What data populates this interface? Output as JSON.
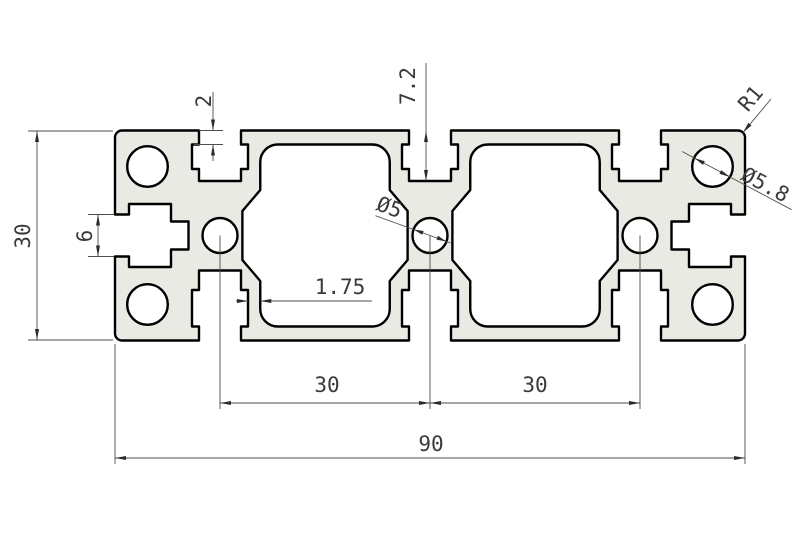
{
  "drawing": {
    "description_labels": {
      "overall_height": "30",
      "slot_opening": "6",
      "lip_thickness": "2",
      "slot_depth": "7.2",
      "corner_radius": "R1",
      "corner_hole_diameter": "Ø5.8",
      "center_hole_diameter": "Ø5",
      "wall_thickness": "1.75",
      "hole_pitch_left": "30",
      "hole_pitch_right": "30",
      "overall_width": "90"
    },
    "colors": {
      "profile_fill": "#e9eae4",
      "outline": "#000000",
      "dimension_line": "#4d4d4d",
      "background": "#ffffff"
    }
  }
}
